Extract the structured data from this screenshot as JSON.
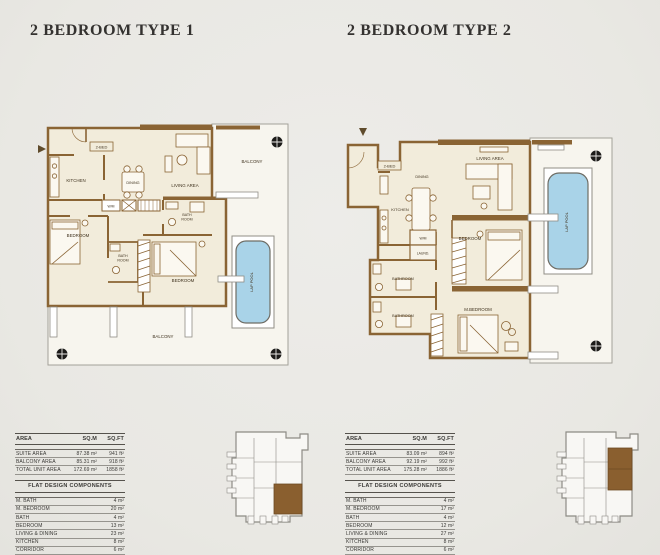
{
  "titles": {
    "plan1": "2 BEDROOM TYPE 1",
    "plan2": "2 BEDROOM TYPE 2"
  },
  "colors": {
    "background": "#ebeae6",
    "wall_brown": "#8a6434",
    "floor_cream": "#f2ecdb",
    "outdoor_floor": "#f7f5ee",
    "pool_blue": "#a9d3e8",
    "keyplan_highlight": "#8a5f2f",
    "title_text": "#343230"
  },
  "plan1": {
    "labels": {
      "unit_tag": "2-BED",
      "kitchen": "KITCHEN",
      "dining": "DINING",
      "living": "LIVING AREA",
      "wm": "W/M",
      "bath1_l1": "BATH",
      "bath1_l2": "ROOM",
      "bedroom1": "BEDROOM",
      "bath2_l1": "BATH",
      "bath2_l2": "ROOM",
      "bedroom2": "BEDROOM",
      "balcony_top": "BALCONY",
      "balcony_bottom": "BALCONY",
      "lap_pool": "LAP POOL"
    }
  },
  "plan2": {
    "labels": {
      "unit_tag": "2-BED",
      "dining": "DINING",
      "kitchen": "KITCHEN",
      "living": "LIVING AREA",
      "wm": "W/M",
      "laundry": "LAUND.",
      "bathroom1": "BATHROOM",
      "bathroom2": "BATHROOM",
      "bedroom": "BEDROOM",
      "m_bedroom": "M.BEDROOM",
      "lap_pool": "LAP POOL"
    }
  },
  "tables": [
    {
      "columns": {
        "area": "AREA",
        "sqm": "SQ.M",
        "sqft": "SQ.FT"
      },
      "rows": [
        {
          "label": "SUITE AREA",
          "sqm": "87.38 m²",
          "sqft": "941 ft²"
        },
        {
          "label": "BALCONY AREA",
          "sqm": "85.31 m²",
          "sqft": "918 ft²"
        },
        {
          "label": "TOTAL UNIT AREA",
          "sqm": "172.69 m²",
          "sqft": "1858 ft²"
        }
      ],
      "section_title": "FLAT DESIGN COMPONENTS",
      "components": [
        {
          "label": "M. BATH",
          "value": "4 m²"
        },
        {
          "label": "M. BEDROOM",
          "value": "20 m²"
        },
        {
          "label": "BATH",
          "value": "4 m²"
        },
        {
          "label": "BEDROOM",
          "value": "13 m²"
        },
        {
          "label": "LIVING & DINING",
          "value": "23 m²"
        },
        {
          "label": "KITCHEN",
          "value": "8 m²"
        },
        {
          "label": "CORRIDOR",
          "value": "6 m²"
        }
      ]
    },
    {
      "columns": {
        "area": "AREA",
        "sqm": "SQ.M",
        "sqft": "SQ.FT"
      },
      "rows": [
        {
          "label": "SUITE AREA",
          "sqm": "83.09 m²",
          "sqft": "894 ft²"
        },
        {
          "label": "BALCONY AREA",
          "sqm": "92.19 m²",
          "sqft": "992 ft²"
        },
        {
          "label": "TOTAL UNIT AREA",
          "sqm": "175.28 m²",
          "sqft": "1886 ft²"
        }
      ],
      "section_title": "FLAT DESIGN COMPONENTS",
      "components": [
        {
          "label": "M. BATH",
          "value": "4 m²"
        },
        {
          "label": "M. BEDROOM",
          "value": "17 m²"
        },
        {
          "label": "BATH",
          "value": "4 m²"
        },
        {
          "label": "BEDROOM",
          "value": "12 m²"
        },
        {
          "label": "LIVING & DINING",
          "value": "27 m²"
        },
        {
          "label": "KITCHEN",
          "value": "8 m²"
        },
        {
          "label": "CORRIDOR",
          "value": "6 m²"
        },
        {
          "label": "LAUNDRY",
          "value": "2 m²"
        }
      ]
    }
  ]
}
